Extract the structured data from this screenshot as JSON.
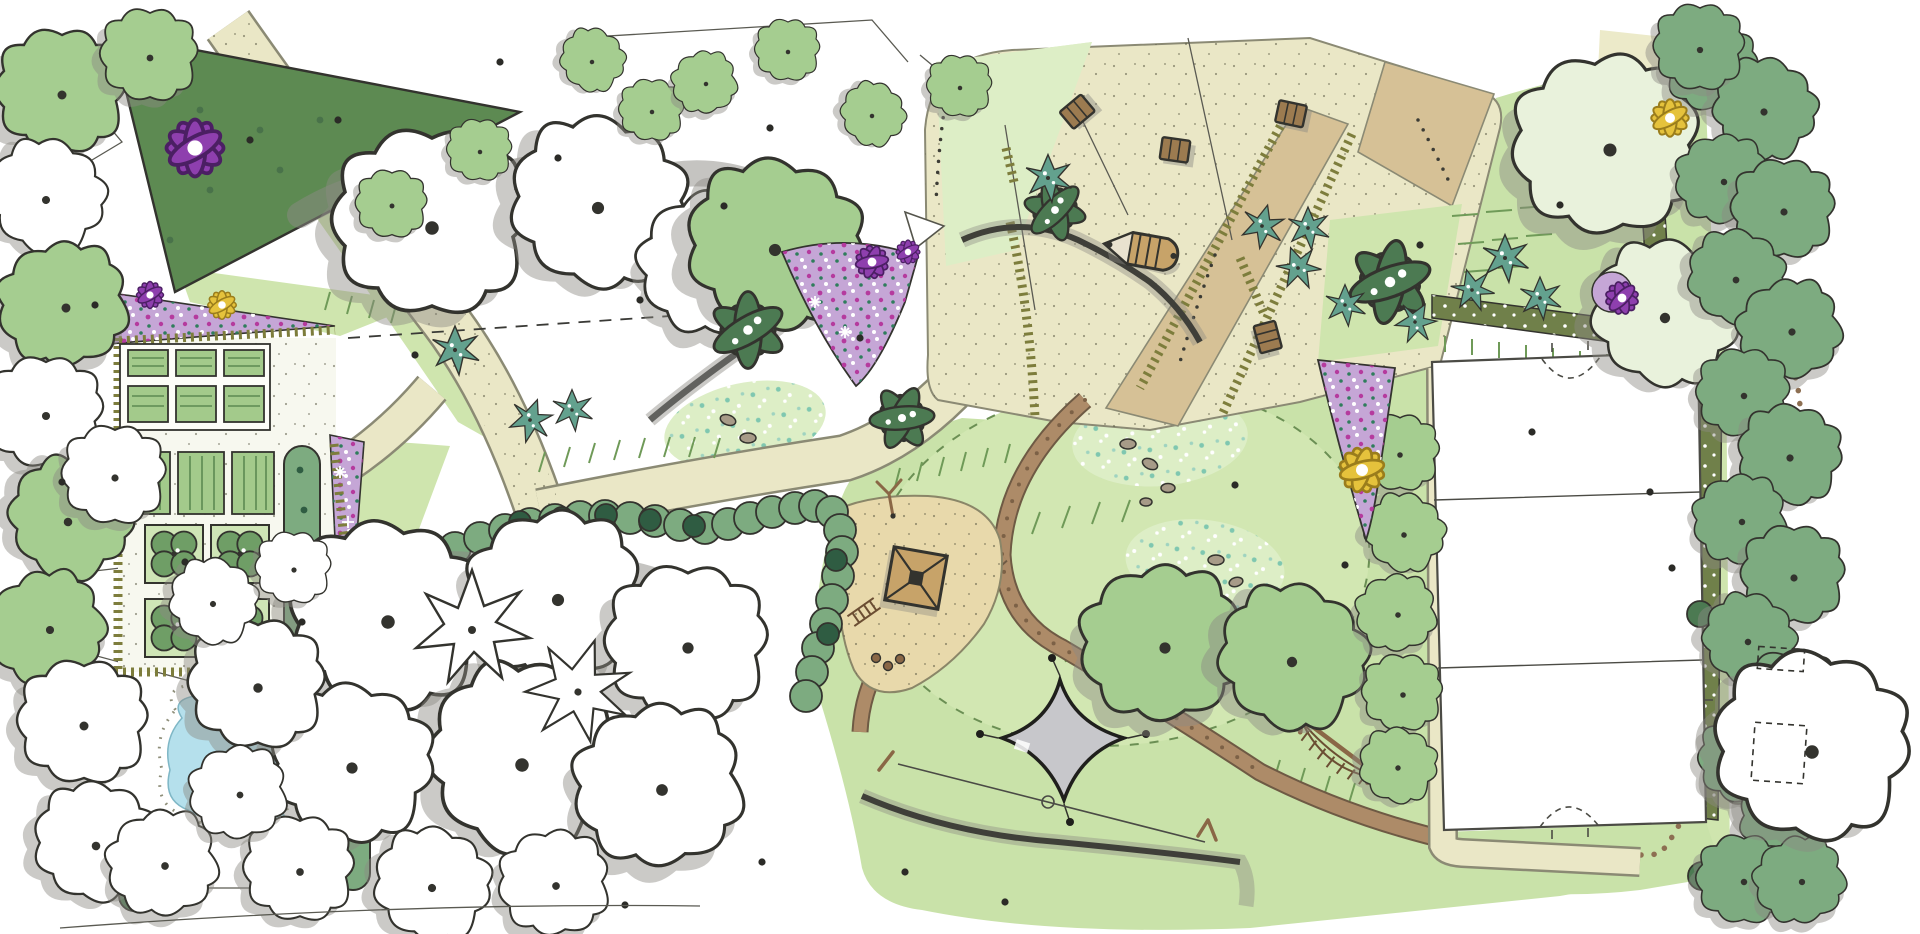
{
  "document": {
    "type": "landscape-architecture-master-plan",
    "title": "Hand-drawn park master plan (marker and watercolour site sketch, top view)",
    "visible_text": "none — the drawing contains no labels or captions",
    "canvas": {
      "width": 1920,
      "height": 934,
      "background": "#ffffff"
    }
  },
  "palette": {
    "paper": "#ffffff",
    "lawn": "#c9e2a9",
    "lawnPale": "#ddeec6",
    "lawnOval": "#d2e7b2",
    "treeLight": "#a5cd90",
    "treePale": "#e9f2dc",
    "treeMid": "#7dab80",
    "treeDark": "#4c7a52",
    "treeDarkest": "#2f5c42",
    "coniferTeal": "#63a18e",
    "grove": "#5d8a52",
    "shadow": "#8b8983",
    "ink": "#33332e",
    "pathCream": "#eae7c6",
    "pathTan": "#d6c196",
    "sand": "#e8d9ab",
    "dirt": "#ad8b68",
    "trail": "#8d6f52",
    "hedge": "#7d7d3c",
    "bandOlive": "#70804a",
    "purpleLight": "#c5a6d6",
    "purpleDark": "#8e3fae",
    "magenta": "#b53a9e",
    "yellow": "#e5c23c",
    "water": "#b5e0ec",
    "wall": "#61615e",
    "sail": "#c7c7cb",
    "wood": "#8a6746",
    "bedGreen": "#a3ca8b",
    "fieldLine": "#4b4b45"
  },
  "map_regions": [
    {
      "id": "entrance-plaza",
      "label": "North entrance plaza with benches and play boat",
      "position": "top centre"
    },
    {
      "id": "community-garden",
      "label": "Community garden: raised beds, quartered parterre beds, hedged enclosure",
      "position": "left"
    },
    {
      "id": "pond",
      "label": "Small pond with gravel margin",
      "position": "lower left"
    },
    {
      "id": "woodland",
      "label": "Existing tree groups drawn as white outline canopies",
      "position": "left and centre"
    },
    {
      "id": "playground",
      "label": "Sand playground with timber climbing tower",
      "position": "centre"
    },
    {
      "id": "event-lawn",
      "label": "Central oval event lawn with meadow fringe",
      "position": "centre right"
    },
    {
      "id": "shade-sail-area",
      "label": "Four-point shade sail and slackline",
      "position": "lower centre"
    },
    {
      "id": "sports-field",
      "label": "Rectangular sports pitch with goal arcs",
      "position": "right"
    },
    {
      "id": "woodland-trail",
      "label": "Winding stepping-stone trail through perimeter shrubs",
      "position": "right edge"
    },
    {
      "id": "grove",
      "label": "Dark green tree grove wedge",
      "position": "top left"
    }
  ],
  "features": {
    "vegetation": [
      {
        "id": "deciduous-tree",
        "label": "Deciduous tree, green canopy with trunk dot",
        "count": 24,
        "color": "#a5cd90"
      },
      {
        "id": "outline-tree",
        "label": "Existing tree, white outline canopy with trunk dot",
        "count": 22,
        "color": "#ffffff"
      },
      {
        "id": "perimeter-tree",
        "label": "Perimeter woodland tree / shrub clump",
        "count": 17,
        "color": "#7dab80"
      },
      {
        "id": "conifer-shrub",
        "label": "Small teal conifer or specimen shrub",
        "count": 12,
        "color": "#63a18e"
      },
      {
        "id": "palmate-shrub",
        "label": "Dark broadleaf specimen shrub",
        "count": 4,
        "color": "#4c7a52"
      },
      {
        "id": "hedge",
        "label": "Clipped hedge rows (olive tick lines)",
        "color": "#7d7d3c"
      },
      {
        "id": "purple-bed",
        "label": "Purple perennial planting bed",
        "count": 4,
        "color": "#c5a6d6"
      },
      {
        "id": "purple-flower",
        "label": "Purple accent flower",
        "count": 5,
        "color": "#8e3fae"
      },
      {
        "id": "yellow-flower",
        "label": "Yellow accent flower",
        "count": 3,
        "color": "#e5c23c"
      },
      {
        "id": "meadow-patch",
        "label": "Speckled wildflower meadow patch",
        "count": 3,
        "color": "#ddeec6"
      },
      {
        "id": "oval-lawn",
        "label": "Mown oval lawn with dashed edge",
        "color": "#d2e7b2"
      }
    ],
    "circulation": [
      {
        "id": "main-path",
        "label": "Main cream footpath",
        "color": "#eae7c6"
      },
      {
        "id": "plaza-paving",
        "label": "Entrance plaza paving",
        "color": "#eae7c6"
      },
      {
        "id": "tan-band",
        "label": "Secondary tan paved band",
        "color": "#d6c196"
      },
      {
        "id": "dirt-trail",
        "label": "Brown play trail",
        "color": "#ad8b68"
      },
      {
        "id": "stepping-stones",
        "label": "Stepping-stone dots along field edge",
        "color": "#8d6f52"
      },
      {
        "id": "woodland-winding-trail",
        "label": "Dotted winding trail in perimeter planting",
        "color": "#8d6f52"
      },
      {
        "id": "desire-lines",
        "label": "Dotted pedestrian desire lines",
        "count": 3
      }
    ],
    "water": [
      {
        "id": "pond",
        "label": "Pond",
        "color": "#b5e0ec"
      }
    ],
    "structures": [
      {
        "id": "sports-field",
        "label": "Sports pitch, white with two cross lines, goal arcs top and bottom",
        "color": "#ffffff"
      },
      {
        "id": "playground-sand",
        "label": "Sand play area",
        "color": "#e8d9ab"
      },
      {
        "id": "play-tower",
        "label": "Square timber play tower with hip roof",
        "count": 1
      },
      {
        "id": "climbing-pole",
        "label": "Y-shaped climbing pole",
        "count": 1
      },
      {
        "id": "ladder",
        "label": "Play ladder",
        "count": 1
      },
      {
        "id": "rope-climber",
        "label": "Timber rope-net climber",
        "count": 1
      },
      {
        "id": "shade-sail",
        "label": "Grey four-point shade sail",
        "count": 1,
        "color": "#c7c7cb"
      },
      {
        "id": "slackline",
        "label": "Slackline between posts with ring",
        "count": 1
      },
      {
        "id": "bench",
        "label": "Timber bench",
        "count": 4
      },
      {
        "id": "play-boat",
        "label": "Timber play boat",
        "count": 1
      },
      {
        "id": "seat-wall",
        "label": "Curved grey seat wall",
        "count": 1,
        "color": "#61615e"
      },
      {
        "id": "shed",
        "label": "Dashed shed / pad outlines",
        "count": 3
      },
      {
        "id": "raised-beds",
        "label": "Striped raised garden beds",
        "count": 9
      },
      {
        "id": "quartered-beds",
        "label": "Quartered parterre beds with shrubs",
        "count": 4
      },
      {
        "id": "entrance-kite",
        "label": "Small white entrance canopy (triangle)",
        "count": 1
      }
    ],
    "annotations": [
      {
        "id": "boundary-dash",
        "label": "Long dashed sight/boundary line through tree group"
      },
      {
        "id": "survey-lines",
        "label": "Thin survey and extension lines at edges"
      },
      {
        "id": "trunk-dots",
        "label": "Black trunk-position dots scattered on canopies and lawn"
      }
    ]
  }
}
